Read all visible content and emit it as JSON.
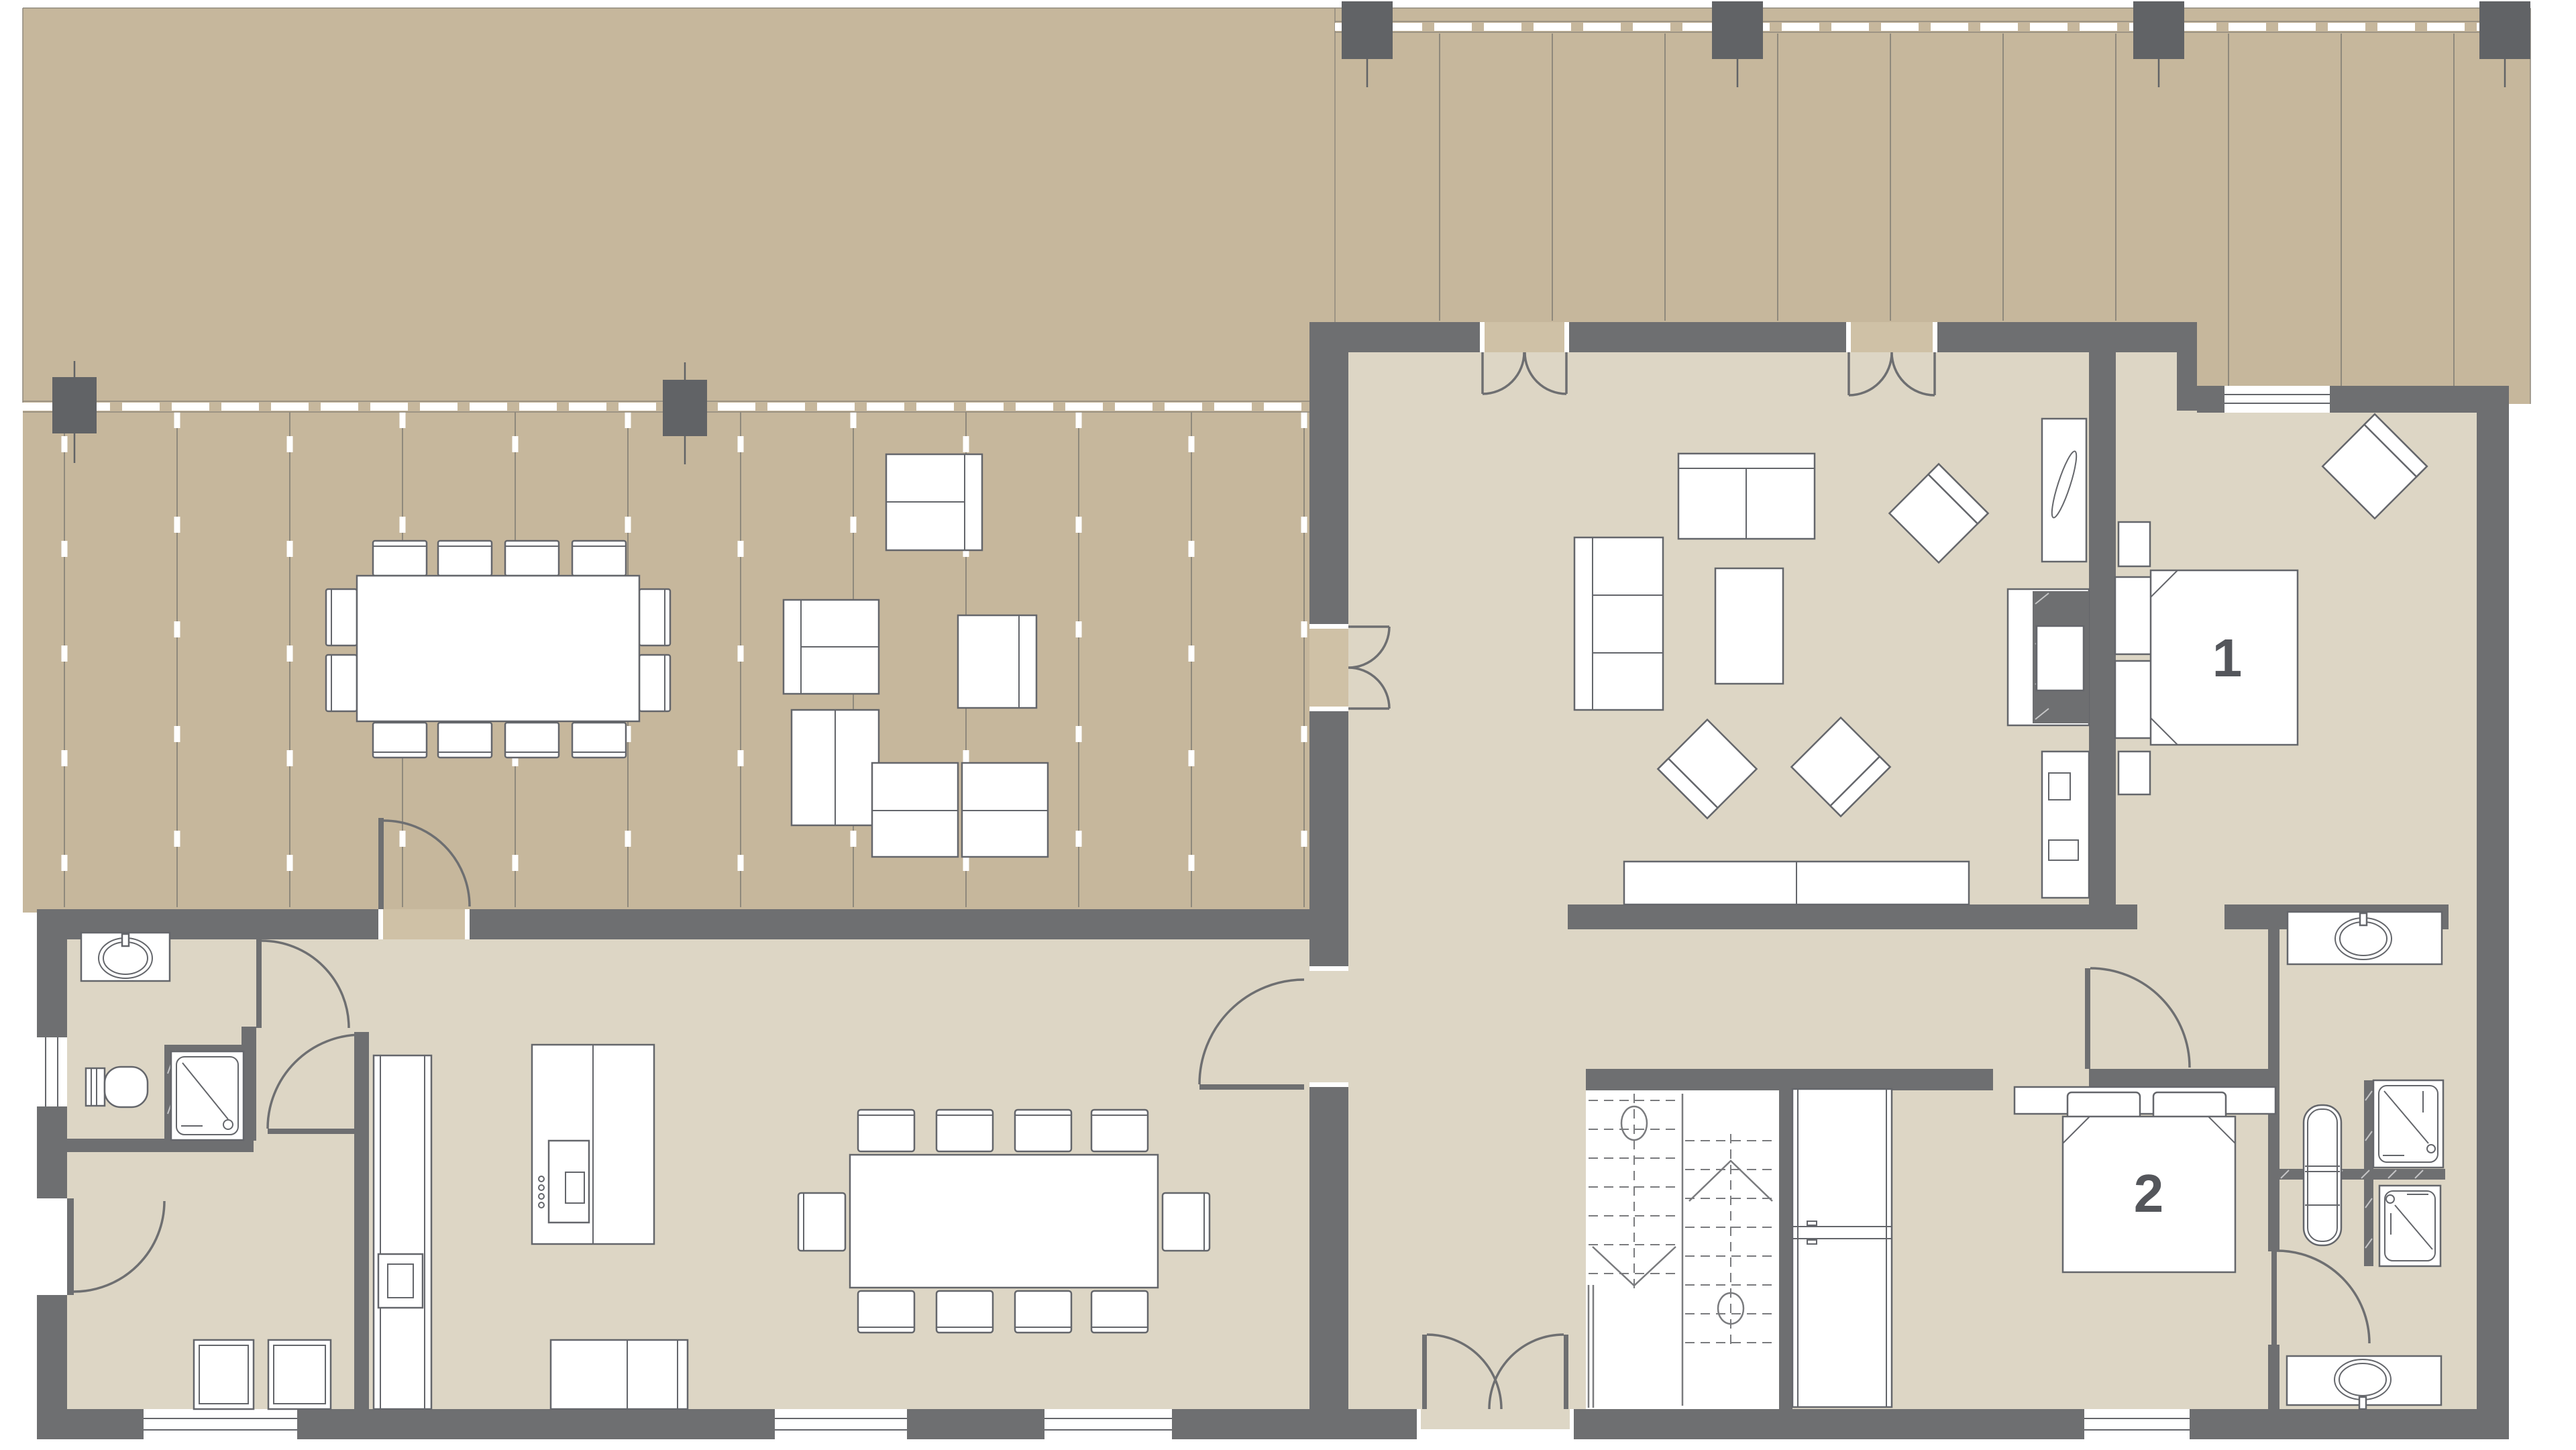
{
  "plan": {
    "type": "residential floor plan",
    "bedroom_labels": {
      "bedroom_1": "1",
      "bedroom_2": "2"
    }
  },
  "colors": {
    "background": "#ffffff",
    "deck": "#c6b79c",
    "deck_line": "#8f897c",
    "floor": "#ddd6c5",
    "wall": "#6e6f71",
    "post": "#616366",
    "furniture_fill": "#ffffff",
    "furniture_stroke": "#64666b",
    "door_sill": "#cfc1a6",
    "door_arc": "#6e6f71",
    "label_text": "#54565b"
  }
}
